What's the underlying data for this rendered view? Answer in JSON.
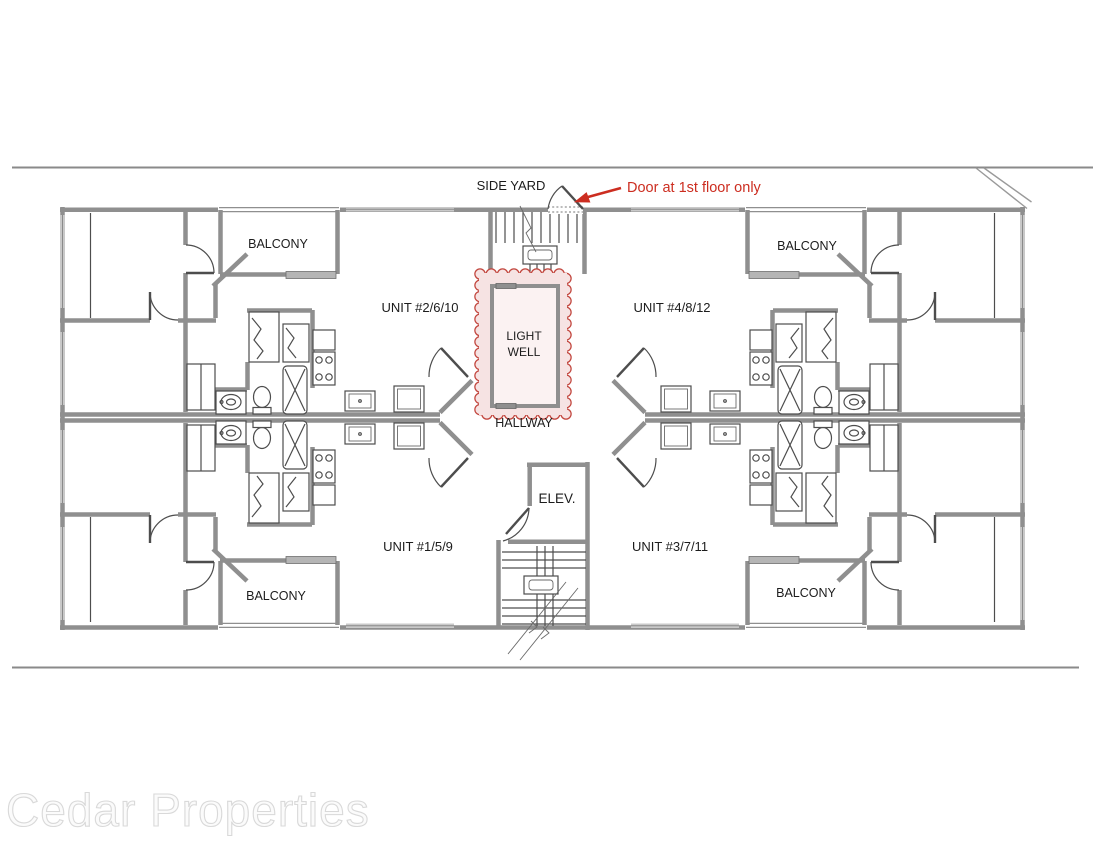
{
  "document": {
    "type": "apartment-building-floor-plan"
  },
  "colors": {
    "annotation_red": "#cc2d20",
    "lightwell_border": "#c2463e",
    "lightwell_fill": "#f6e3e3",
    "lightwell_inner_fill": "#fbf2f2",
    "wall_gray": "#8f8f8f",
    "line_dark": "#4d4d4d",
    "watermark_fill": "#fbfbfb"
  },
  "site": {
    "side_yard_label": "SIDE YARD"
  },
  "annotation": {
    "door_note": "Door at 1st floor only"
  },
  "units": {
    "top_left": "UNIT #2/6/10",
    "top_right": "UNIT #4/8/12",
    "bottom_left": "UNIT #1/5/9",
    "bottom_right": "UNIT #3/7/11"
  },
  "balconies": {
    "top_left": "BALCONY",
    "top_right": "BALCONY",
    "bottom_left": "BALCONY",
    "bottom_right": "BALCONY"
  },
  "core": {
    "light_well_line1": "LIGHT",
    "light_well_line2": "WELL",
    "hallway_label": "HALLWAY",
    "elevator_label": "ELEV."
  },
  "watermark": "Cedar Properties"
}
